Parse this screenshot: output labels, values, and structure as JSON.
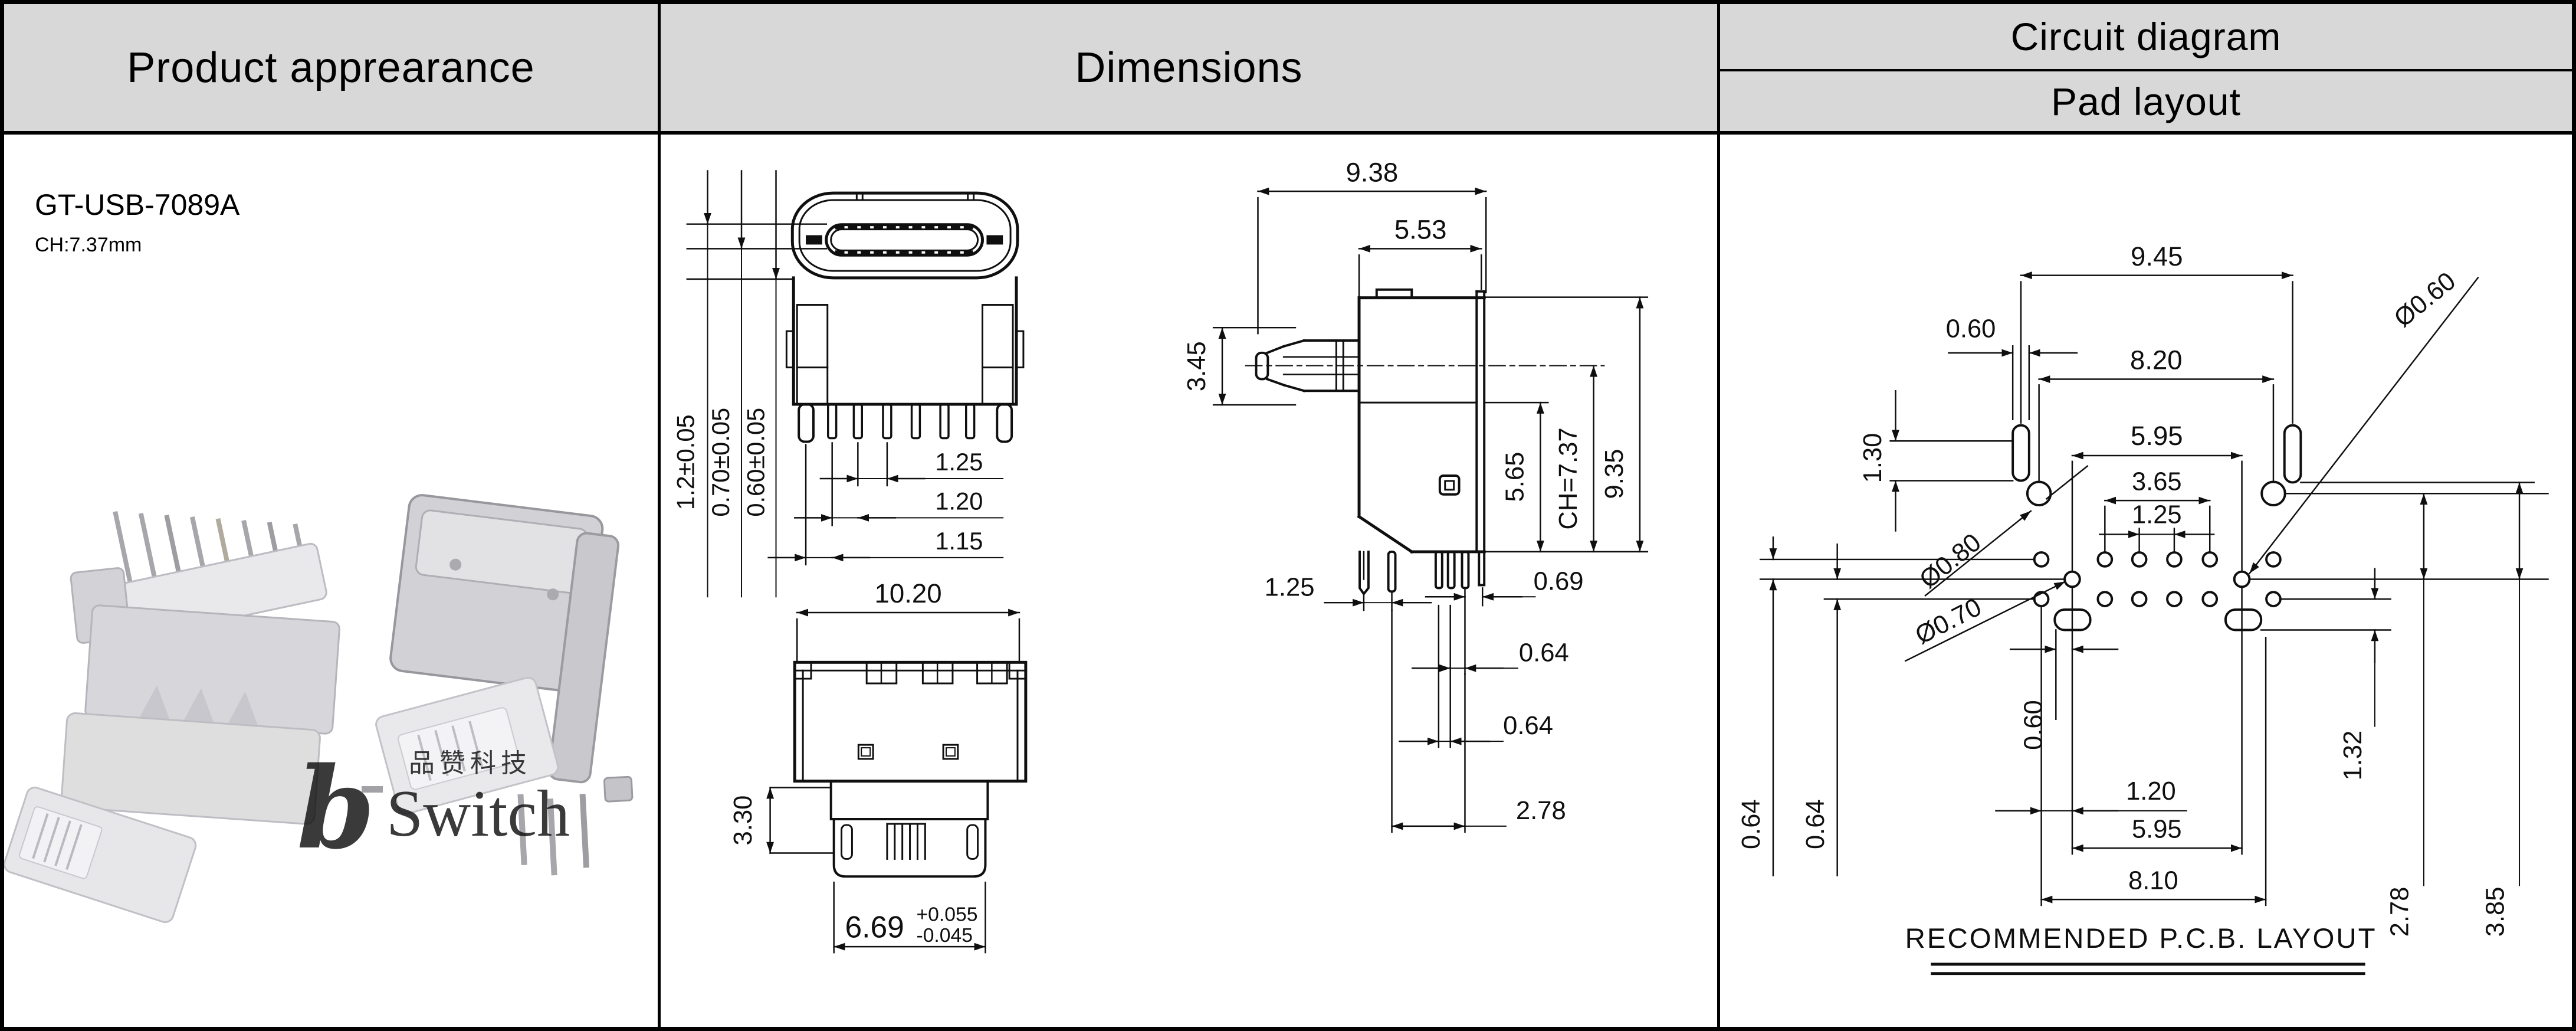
{
  "header": {
    "product": "Product apprearance",
    "dimensions": "Dimensions",
    "circuit": "Circuit diagram",
    "pad": "Pad layout"
  },
  "product": {
    "part_number": "GT-USB-7089A",
    "ch": "CH:7.37mm",
    "watermark": {
      "cn": "品赞科技",
      "b": "b",
      "name": "Switch"
    }
  },
  "front": {
    "d1": "1.2±0.05",
    "d2": "0.70±0.05",
    "d3": "0.60±0.05",
    "p1": "1.25",
    "p2": "1.20",
    "p3": "1.15"
  },
  "bottom": {
    "w": "10.20",
    "h": "3.30",
    "tw": "6.69",
    "tp": "+0.055",
    "tm": "-0.045"
  },
  "side": {
    "d1": "9.38",
    "d2": "5.53",
    "d3": "3.45",
    "d4": "5.65",
    "d5": "CH=7.37",
    "d6": "9.35",
    "b1": "1.25",
    "b2": "0.69",
    "b3": "0.64",
    "b4": "0.64",
    "b5": "2.78"
  },
  "pad": {
    "d1": "9.45",
    "d2": "8.20",
    "d3": "0.60",
    "d4": "1.30",
    "d5": "5.95",
    "d6": "Ø0.60",
    "d7": "3.65",
    "d8": "1.25",
    "d9": "Ø0.80",
    "d10": "Ø0.70",
    "d11": "0.60",
    "d12": "1.32",
    "d13": "1.20",
    "d14": "5.95",
    "d15": "8.10",
    "d16": "0.64",
    "d17": "0.64",
    "d18": "2.78",
    "d19": "3.85",
    "caption": "RECOMMENDED  P.C.B. LAYOUT"
  }
}
